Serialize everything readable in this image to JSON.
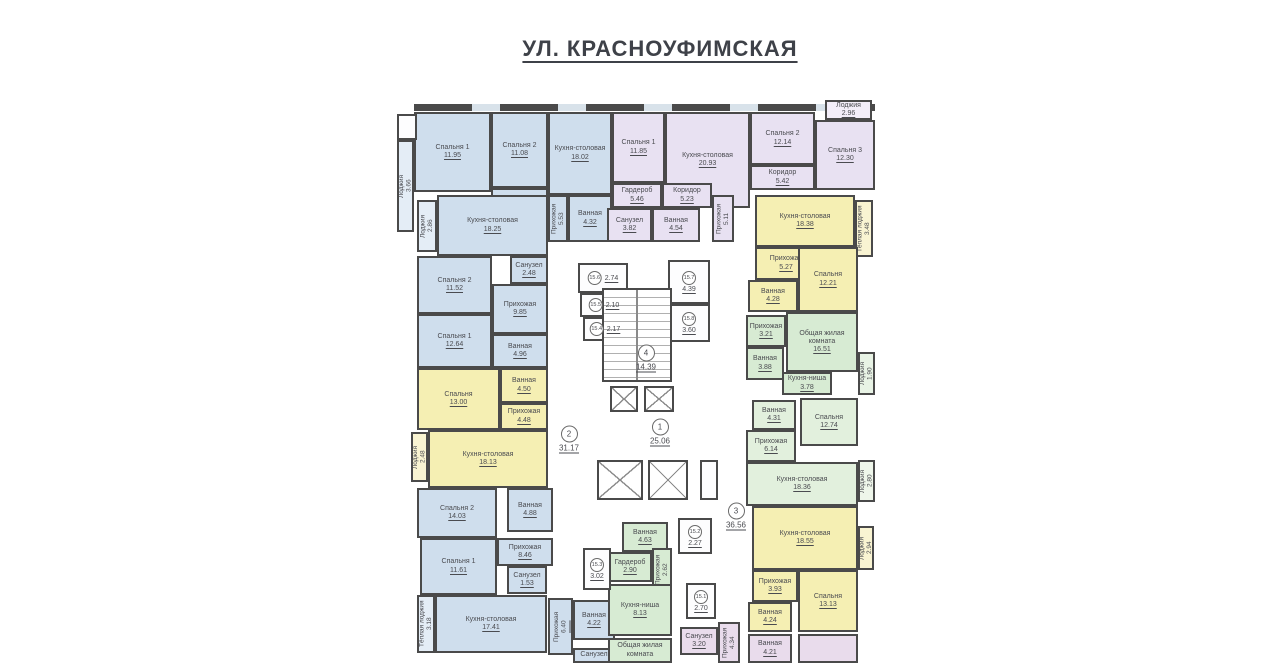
{
  "title": "УЛ. КРАСНОУФИМСКАЯ",
  "colors": {
    "wall": "#4a4a4a",
    "blue": "#cfdeed",
    "blueL": "#e4edf6",
    "yel": "#f5efb3",
    "yelL": "#f9f4d2",
    "lav": "#e8e1f2",
    "lavL": "#f3eef9",
    "grn": "#d7ebd3",
    "grnL": "#e8f3e5",
    "grn2": "#e2f0dd",
    "grn2L": "#eef6ea",
    "pnk": "#e9dcec",
    "wht": "#fdfdfe"
  },
  "plan": {
    "rooms": [
      {
        "n": "Лоджия",
        "a": "3.66",
        "x": 397,
        "y": 140,
        "w": 17,
        "h": 92,
        "c": "blueL",
        "v": 1
      },
      {
        "n": "Спальня 1",
        "a": "11.95",
        "x": 414,
        "y": 112,
        "w": 77,
        "h": 80,
        "c": "blue"
      },
      {
        "n": "Спальня 2",
        "a": "11.08",
        "x": 491,
        "y": 112,
        "w": 57,
        "h": 76,
        "c": "blue"
      },
      {
        "n": "Кухня-столовая",
        "a": "18.02",
        "x": 548,
        "y": 112,
        "w": 64,
        "h": 83,
        "c": "blue"
      },
      {
        "n": "Коридор",
        "a": "4.11",
        "x": 491,
        "y": 188,
        "w": 57,
        "h": 54,
        "c": "blue"
      },
      {
        "n": "Прихожая",
        "a": "5.53",
        "x": 548,
        "y": 195,
        "w": 20,
        "h": 47,
        "c": "blue",
        "v": 1
      },
      {
        "n": "Ванная",
        "a": "4.32",
        "x": 568,
        "y": 195,
        "w": 44,
        "h": 47,
        "c": "blue"
      },
      {
        "n": "Кухня-столовая",
        "a": "18.25",
        "x": 437,
        "y": 195,
        "w": 111,
        "h": 61,
        "c": "blue"
      },
      {
        "n": "Лоджия",
        "a": "2.86",
        "x": 417,
        "y": 200,
        "w": 20,
        "h": 52,
        "c": "blueL",
        "v": 1
      },
      {
        "n": "Санузел",
        "a": "2.48",
        "x": 510,
        "y": 256,
        "w": 38,
        "h": 28,
        "c": "blue"
      },
      {
        "n": "Спальня 2",
        "a": "11.52",
        "x": 417,
        "y": 256,
        "w": 75,
        "h": 58,
        "c": "blue"
      },
      {
        "n": "Прихожая",
        "a": "9.85",
        "x": 492,
        "y": 284,
        "w": 56,
        "h": 50,
        "c": "blue"
      },
      {
        "n": "Спальня 1",
        "a": "12.64",
        "x": 417,
        "y": 314,
        "w": 75,
        "h": 54,
        "c": "blue"
      },
      {
        "n": "Ванная",
        "a": "4.96",
        "x": 492,
        "y": 334,
        "w": 56,
        "h": 34,
        "c": "blue"
      },
      {
        "n": "Спальня",
        "a": "13.00",
        "x": 417,
        "y": 368,
        "w": 83,
        "h": 62,
        "c": "yel"
      },
      {
        "n": "Ванная",
        "a": "4.50",
        "x": 500,
        "y": 368,
        "w": 48,
        "h": 35,
        "c": "yel"
      },
      {
        "n": "Прихожая",
        "a": "4.48",
        "x": 500,
        "y": 403,
        "w": 48,
        "h": 27,
        "c": "yel"
      },
      {
        "n": "Кухня-столовая",
        "a": "18.13",
        "x": 428,
        "y": 430,
        "w": 120,
        "h": 58,
        "c": "yel"
      },
      {
        "n": "Лоджия",
        "a": "2.48",
        "x": 411,
        "y": 432,
        "w": 17,
        "h": 50,
        "c": "yelL",
        "v": 1
      },
      {
        "n": "Спальня 2",
        "a": "14.03",
        "x": 417,
        "y": 488,
        "w": 80,
        "h": 50,
        "c": "blue"
      },
      {
        "n": "Ванная",
        "a": "4.88",
        "x": 507,
        "y": 488,
        "w": 46,
        "h": 44,
        "c": "blue"
      },
      {
        "n": "Прихожая",
        "a": "8.46",
        "x": 497,
        "y": 538,
        "w": 56,
        "h": 28,
        "c": "blue"
      },
      {
        "n": "Спальня 1",
        "a": "11.61",
        "x": 420,
        "y": 538,
        "w": 77,
        "h": 57,
        "c": "blue"
      },
      {
        "n": "Санузел",
        "a": "1.53",
        "x": 507,
        "y": 566,
        "w": 40,
        "h": 28,
        "c": "blue"
      },
      {
        "n": "Кухня-столовая",
        "a": "17.41",
        "x": 435,
        "y": 595,
        "w": 112,
        "h": 58,
        "c": "blue"
      },
      {
        "n": "Тёплая лоджия",
        "a": "3.18",
        "x": 417,
        "y": 595,
        "w": 18,
        "h": 58,
        "c": "blueL",
        "v": 1
      },
      {
        "n": "Прихожая",
        "a": "6.40",
        "x": 548,
        "y": 598,
        "w": 25,
        "h": 57,
        "c": "blue",
        "v": 1
      },
      {
        "n": "Ванная",
        "a": "4.22",
        "x": 573,
        "y": 600,
        "w": 42,
        "h": 40,
        "c": "blue"
      },
      {
        "n": "Санузел",
        "a": "",
        "x": 573,
        "y": 648,
        "w": 42,
        "h": 15,
        "c": "blue"
      },
      {
        "n": "Спальня 1",
        "a": "11.85",
        "x": 612,
        "y": 112,
        "w": 53,
        "h": 71,
        "c": "lav"
      },
      {
        "n": "Кухня-столовая",
        "a": "20.93",
        "x": 665,
        "y": 112,
        "w": 85,
        "h": 96,
        "c": "lav"
      },
      {
        "n": "Спальня 2",
        "a": "12.14",
        "x": 750,
        "y": 112,
        "w": 65,
        "h": 53,
        "c": "lav"
      },
      {
        "n": "Коридор",
        "a": "5.42",
        "x": 750,
        "y": 165,
        "w": 65,
        "h": 25,
        "c": "lav"
      },
      {
        "n": "Спальня 3",
        "a": "12.30",
        "x": 815,
        "y": 120,
        "w": 60,
        "h": 70,
        "c": "lav"
      },
      {
        "n": "Лоджия",
        "a": "2.96",
        "x": 825,
        "y": 100,
        "w": 47,
        "h": 20,
        "c": "lavL"
      },
      {
        "n": "Гардероб",
        "a": "5.46",
        "x": 612,
        "y": 183,
        "w": 50,
        "h": 25,
        "c": "lav"
      },
      {
        "n": "Коридор",
        "a": "5.23",
        "x": 662,
        "y": 183,
        "w": 50,
        "h": 25,
        "c": "lav"
      },
      {
        "n": "Санузел",
        "a": "3.82",
        "x": 607,
        "y": 208,
        "w": 45,
        "h": 34,
        "c": "lav"
      },
      {
        "n": "Ванная",
        "a": "4.54",
        "x": 652,
        "y": 208,
        "w": 48,
        "h": 34,
        "c": "lav"
      },
      {
        "n": "Прихожая",
        "a": "5.11",
        "x": 712,
        "y": 195,
        "w": 22,
        "h": 47,
        "c": "lav",
        "v": 1
      },
      {
        "n": "Кухня-столовая",
        "a": "18.38",
        "x": 755,
        "y": 195,
        "w": 100,
        "h": 52,
        "c": "yel"
      },
      {
        "n": "Тёплая лоджия",
        "a": "3.48",
        "x": 855,
        "y": 200,
        "w": 18,
        "h": 57,
        "c": "yelL",
        "v": 1
      },
      {
        "n": "Прихожая",
        "a": "5.27",
        "x": 755,
        "y": 247,
        "w": 62,
        "h": 33,
        "c": "yel"
      },
      {
        "n": "Ванная",
        "a": "4.28",
        "x": 748,
        "y": 280,
        "w": 50,
        "h": 32,
        "c": "yel"
      },
      {
        "n": "Спальня",
        "a": "12.21",
        "x": 798,
        "y": 247,
        "w": 60,
        "h": 65,
        "c": "yel"
      },
      {
        "n": "Прихожая",
        "a": "3.21",
        "x": 746,
        "y": 315,
        "w": 40,
        "h": 32,
        "c": "grn"
      },
      {
        "n": "Общая жилая комната",
        "a": "16.51",
        "x": 786,
        "y": 312,
        "w": 72,
        "h": 60,
        "c": "grn"
      },
      {
        "n": "Ванная",
        "a": "3.88",
        "x": 746,
        "y": 347,
        "w": 38,
        "h": 33,
        "c": "grn"
      },
      {
        "n": "Кухня-ниша",
        "a": "3.78",
        "x": 782,
        "y": 372,
        "w": 50,
        "h": 23,
        "c": "grn"
      },
      {
        "n": "Лоджия",
        "a": "1.90",
        "x": 858,
        "y": 352,
        "w": 17,
        "h": 43,
        "c": "grnL",
        "v": 1
      },
      {
        "n": "Ванная",
        "a": "4.31",
        "x": 752,
        "y": 400,
        "w": 44,
        "h": 30,
        "c": "grn2"
      },
      {
        "n": "Спальня",
        "a": "12.74",
        "x": 800,
        "y": 398,
        "w": 58,
        "h": 48,
        "c": "grn2"
      },
      {
        "n": "Прихожая",
        "a": "6.14",
        "x": 746,
        "y": 430,
        "w": 50,
        "h": 32,
        "c": "grn2"
      },
      {
        "n": "Кухня-столовая",
        "a": "18.36",
        "x": 746,
        "y": 462,
        "w": 112,
        "h": 44,
        "c": "grn2"
      },
      {
        "n": "Лоджия",
        "a": "2.80",
        "x": 858,
        "y": 460,
        "w": 17,
        "h": 42,
        "c": "grn2L",
        "v": 1
      },
      {
        "n": "Кухня-столовая",
        "a": "18.55",
        "x": 752,
        "y": 506,
        "w": 106,
        "h": 64,
        "c": "yel"
      },
      {
        "n": "Лоджия",
        "a": "2.94",
        "x": 858,
        "y": 526,
        "w": 16,
        "h": 44,
        "c": "yelL",
        "v": 1
      },
      {
        "n": "Прихожая",
        "a": "3.93",
        "x": 752,
        "y": 570,
        "w": 46,
        "h": 32,
        "c": "yel"
      },
      {
        "n": "Ванная",
        "a": "4.24",
        "x": 748,
        "y": 602,
        "w": 44,
        "h": 30,
        "c": "yel"
      },
      {
        "n": "Спальня",
        "a": "13.13",
        "x": 798,
        "y": 570,
        "w": 60,
        "h": 62,
        "c": "yel"
      },
      {
        "n": "Санузел",
        "a": "3.20",
        "x": 680,
        "y": 627,
        "w": 38,
        "h": 28,
        "c": "pnk"
      },
      {
        "n": "Прихожая",
        "a": "4.34",
        "x": 718,
        "y": 622,
        "w": 22,
        "h": 41,
        "c": "pnk",
        "v": 1
      },
      {
        "n": "Ванная",
        "a": "4.21",
        "x": 748,
        "y": 634,
        "w": 44,
        "h": 29,
        "c": "pnk"
      },
      {
        "n": "Ванная",
        "a": "4.63",
        "x": 622,
        "y": 522,
        "w": 46,
        "h": 30,
        "c": "grn"
      },
      {
        "n": "Гардероб",
        "a": "2.90",
        "x": 608,
        "y": 552,
        "w": 44,
        "h": 30,
        "c": "grn"
      },
      {
        "n": "Прихожая",
        "a": "2.62",
        "x": 652,
        "y": 548,
        "w": 20,
        "h": 44,
        "c": "grn",
        "v": 1
      },
      {
        "n": "Кухня-ниша",
        "a": "8.13",
        "x": 608,
        "y": 584,
        "w": 64,
        "h": 52,
        "c": "grn"
      },
      {
        "n": "Общая жилая комната",
        "a": "",
        "x": 608,
        "y": 638,
        "w": 64,
        "h": 25,
        "c": "grn"
      }
    ],
    "storerooms": [
      {
        "x": 578,
        "y": 263,
        "w": 50,
        "h": 30
      },
      {
        "x": 580,
        "y": 293,
        "w": 48,
        "h": 24
      },
      {
        "x": 583,
        "y": 317,
        "w": 45,
        "h": 24
      },
      {
        "x": 668,
        "y": 260,
        "w": 42,
        "h": 44
      },
      {
        "x": 668,
        "y": 304,
        "w": 42,
        "h": 38
      },
      {
        "x": 678,
        "y": 518,
        "w": 34,
        "h": 36
      },
      {
        "x": 583,
        "y": 548,
        "w": 28,
        "h": 42
      },
      {
        "x": 686,
        "y": 583,
        "w": 30,
        "h": 36
      },
      {
        "x": 700,
        "y": 460,
        "w": 18,
        "h": 40
      }
    ],
    "markers": [
      {
        "id": "15.6",
        "val": "2.74",
        "x": 603,
        "y": 278,
        "row": 1
      },
      {
        "id": "15.5",
        "val": "2.10",
        "x": 604,
        "y": 305,
        "row": 1
      },
      {
        "id": "15.4",
        "val": "2.17",
        "x": 605,
        "y": 329,
        "row": 1
      },
      {
        "id": "15.7",
        "val": "4.39",
        "x": 689,
        "y": 282
      },
      {
        "id": "15.8",
        "val": "3.60",
        "x": 689,
        "y": 323
      },
      {
        "id": "15.2",
        "val": "2.27",
        "x": 695,
        "y": 536
      },
      {
        "id": "15.3",
        "val": "3.02",
        "x": 597,
        "y": 569
      },
      {
        "id": "15.1",
        "val": "2.70",
        "x": 701,
        "y": 601
      },
      {
        "id": "4",
        "val": "14.39",
        "x": 646,
        "y": 358,
        "big": 1
      },
      {
        "id": "1",
        "val": "25.06",
        "x": 660,
        "y": 432,
        "big": 1
      },
      {
        "id": "2",
        "val": "31.17",
        "x": 569,
        "y": 439,
        "big": 1
      },
      {
        "id": "3",
        "val": "36.56",
        "x": 736,
        "y": 516,
        "big": 1
      }
    ],
    "elevators": [
      {
        "x": 610,
        "y": 386,
        "w": 28,
        "h": 26
      },
      {
        "x": 644,
        "y": 386,
        "w": 30,
        "h": 26
      },
      {
        "x": 597,
        "y": 460,
        "w": 46,
        "h": 40
      },
      {
        "x": 648,
        "y": 460,
        "w": 40,
        "h": 40
      }
    ],
    "stairs": {
      "x": 602,
      "y": 288,
      "w": 70,
      "h": 94
    },
    "patches": [
      {
        "x": 397,
        "y": 114,
        "w": 20,
        "h": 26,
        "c": "wht"
      },
      {
        "x": 798,
        "y": 634,
        "w": 60,
        "h": 29,
        "c": "pnk"
      }
    ]
  }
}
